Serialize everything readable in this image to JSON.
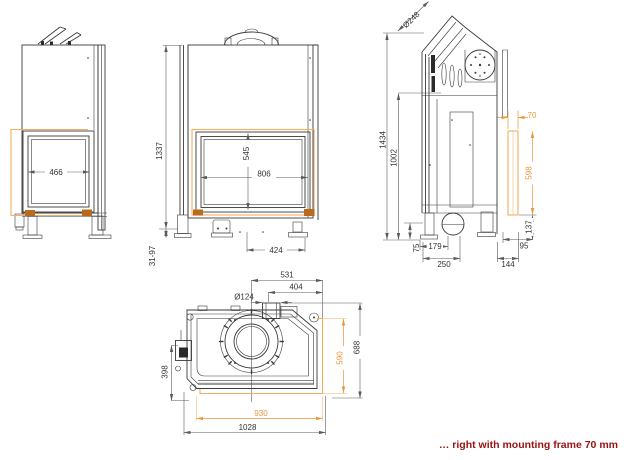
{
  "caption": {
    "text": "… right with mounting frame 70 mm"
  },
  "colors": {
    "line_dark": "#3A3A3A",
    "dim_gray": "#5A5A5A",
    "accent_orange": "#E8963C",
    "frame_orange": "#F4AE62",
    "corner_orange": "#B96A1A",
    "caption_red": "#991111",
    "background": "#FFFFFF"
  },
  "views": {
    "side_window_view": {
      "dims": {
        "glass_width": "466"
      }
    },
    "front_view": {
      "dims": {
        "total_height": "1337",
        "leg_adjustment": "31-97",
        "glass_height": "545",
        "glass_width": "806",
        "foot_spacing": "424"
      }
    },
    "side_profile_view": {
      "dims": {
        "flue_diameter": "Ø248",
        "overall_height": "1434",
        "body_height": "1002",
        "frame_depth": "70",
        "frame_length": "598",
        "frame_bottom_offset": "137",
        "rear_offset": "95",
        "rear_total": "144",
        "foot_height": "75",
        "inlet_offset": "179",
        "base_depth": "250"
      }
    },
    "plan_view": {
      "dims": {
        "flue_center_offset": "531",
        "intake_center_offset": "404",
        "intake_diameter": "Ø124",
        "left_depth": "398",
        "frame_depth": "590",
        "total_depth": "688",
        "frame_width": "930",
        "total_width": "1028"
      }
    }
  }
}
